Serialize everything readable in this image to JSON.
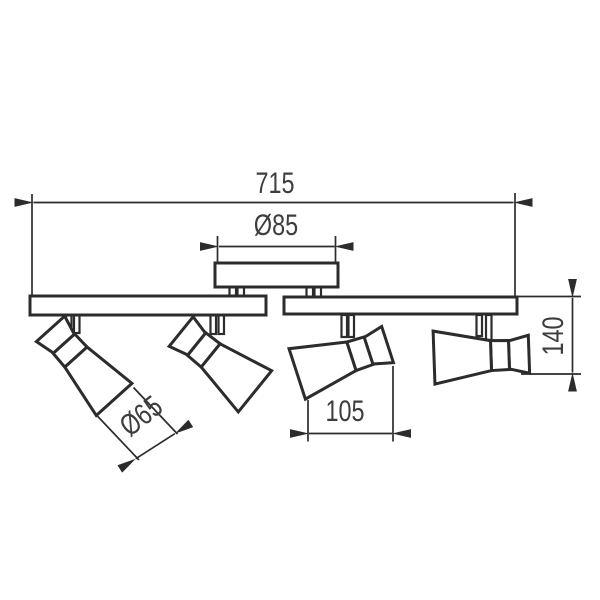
{
  "labels": {
    "overall_width": "715",
    "canopy_diameter": "Ø85",
    "head_diameter": "Ø65",
    "head_width": "105",
    "height": "140"
  },
  "colors": {
    "line": "#2c2c2c",
    "text": "#3e3e3e",
    "background": "#ffffff"
  }
}
